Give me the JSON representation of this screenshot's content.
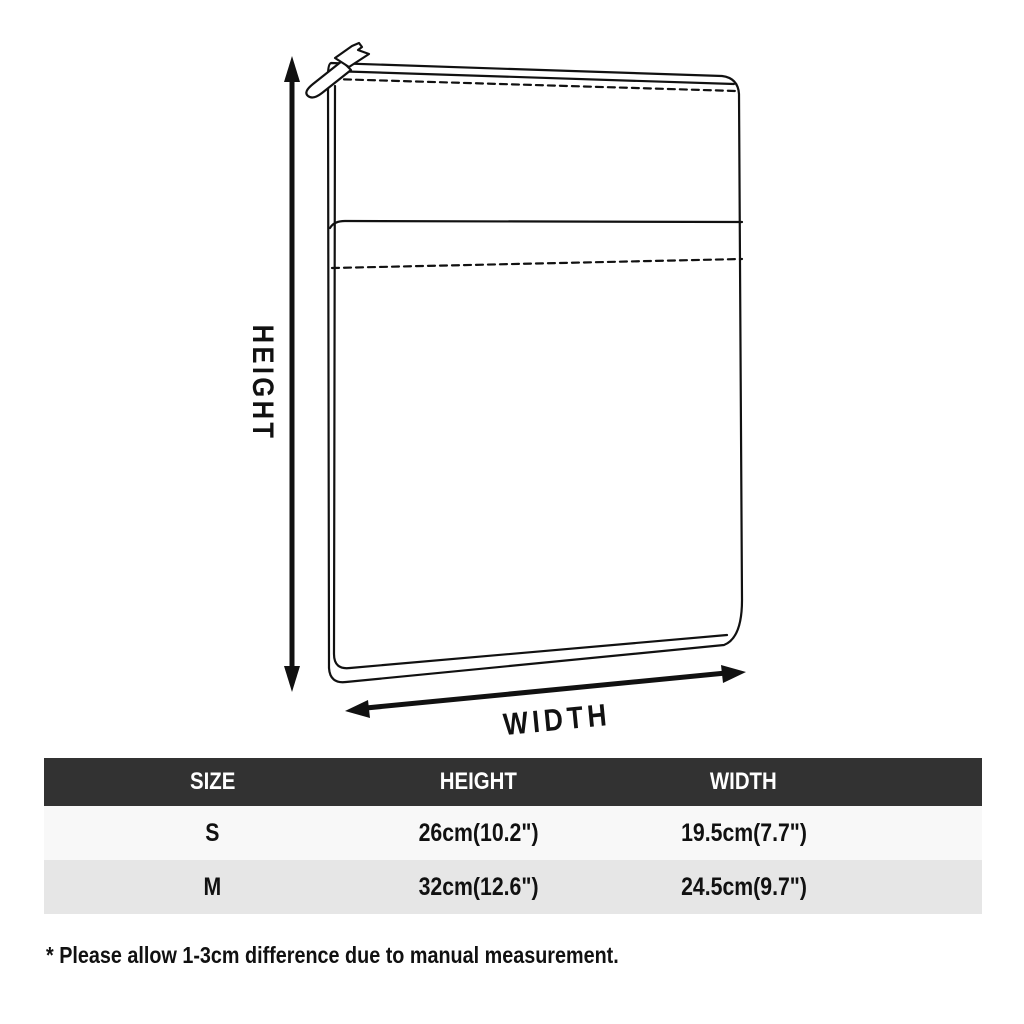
{
  "diagram": {
    "product_drawing": "laptop-sleeve-with-zipper-line-drawing",
    "height_label": "HEIGHT",
    "width_label": "WIDTH",
    "line_color": "#111111"
  },
  "table": {
    "headers": [
      "SIZE",
      "HEIGHT",
      "WIDTH"
    ],
    "rows": [
      [
        "S",
        "26cm(10.2\")",
        "19.5cm(7.7\")"
      ],
      [
        "M",
        "32cm(12.6\")",
        "24.5cm(9.7\")"
      ]
    ],
    "colors": {
      "header_bg": "#323232",
      "header_text": "#ffffff",
      "row_odd_bg": "#f8f8f8",
      "row_even_bg": "#e6e6e6"
    }
  },
  "footnote": "* Please allow 1-3cm difference due to manual measurement."
}
